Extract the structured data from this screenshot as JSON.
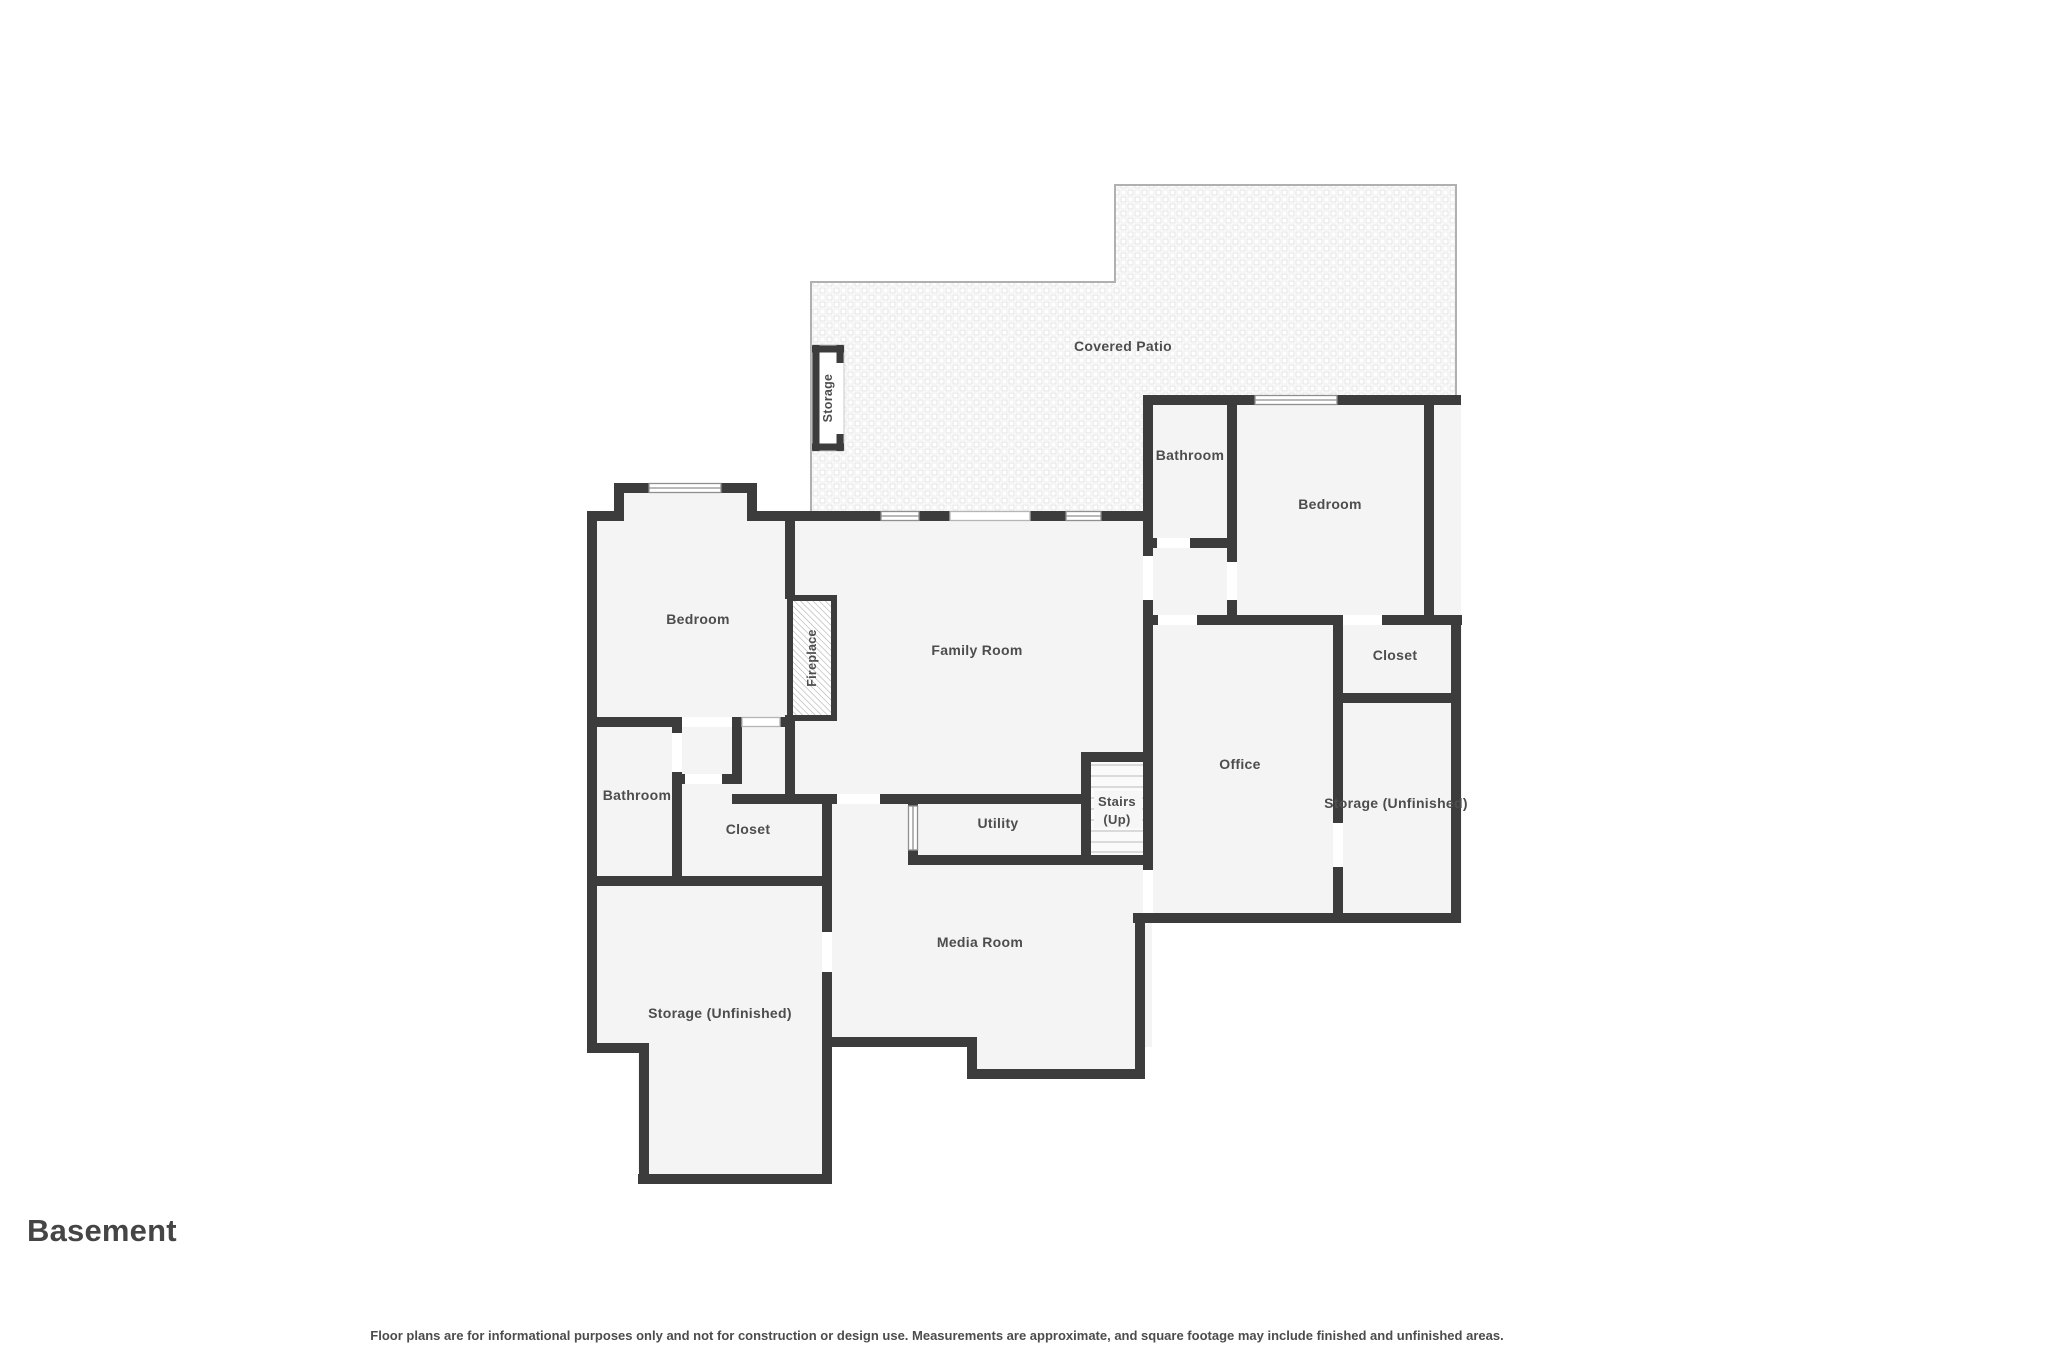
{
  "floor_plan": {
    "title": "Basement",
    "disclaimer": "Floor plans are for informational purposes only and not for construction or design use. Measurements are approximate, and square footage may include finished and unfinished areas.",
    "rooms": {
      "covered_patio": "Covered Patio",
      "storage_patio": "Storage",
      "bathroom_top": "Bathroom",
      "bedroom_right": "Bedroom",
      "bedroom_left": "Bedroom",
      "fireplace": "Fireplace",
      "family_room": "Family Room",
      "closet_right": "Closet",
      "office": "Office",
      "storage_right": "Storage (Unfinished)",
      "bathroom_left": "Bathroom",
      "closet_left": "Closet",
      "utility": "Utility",
      "stairs_line1": "Stairs",
      "stairs_line2": "(Up)",
      "media_room": "Media Room",
      "storage_bottom": "Storage (Unfinished)"
    },
    "colors": {
      "wall": "#3c3c3c",
      "room_fill": "#f4f4f4",
      "label": "#4d4d4d",
      "patio_outline": "#b0b0b0",
      "window_frame": "#8f8f8f"
    }
  }
}
